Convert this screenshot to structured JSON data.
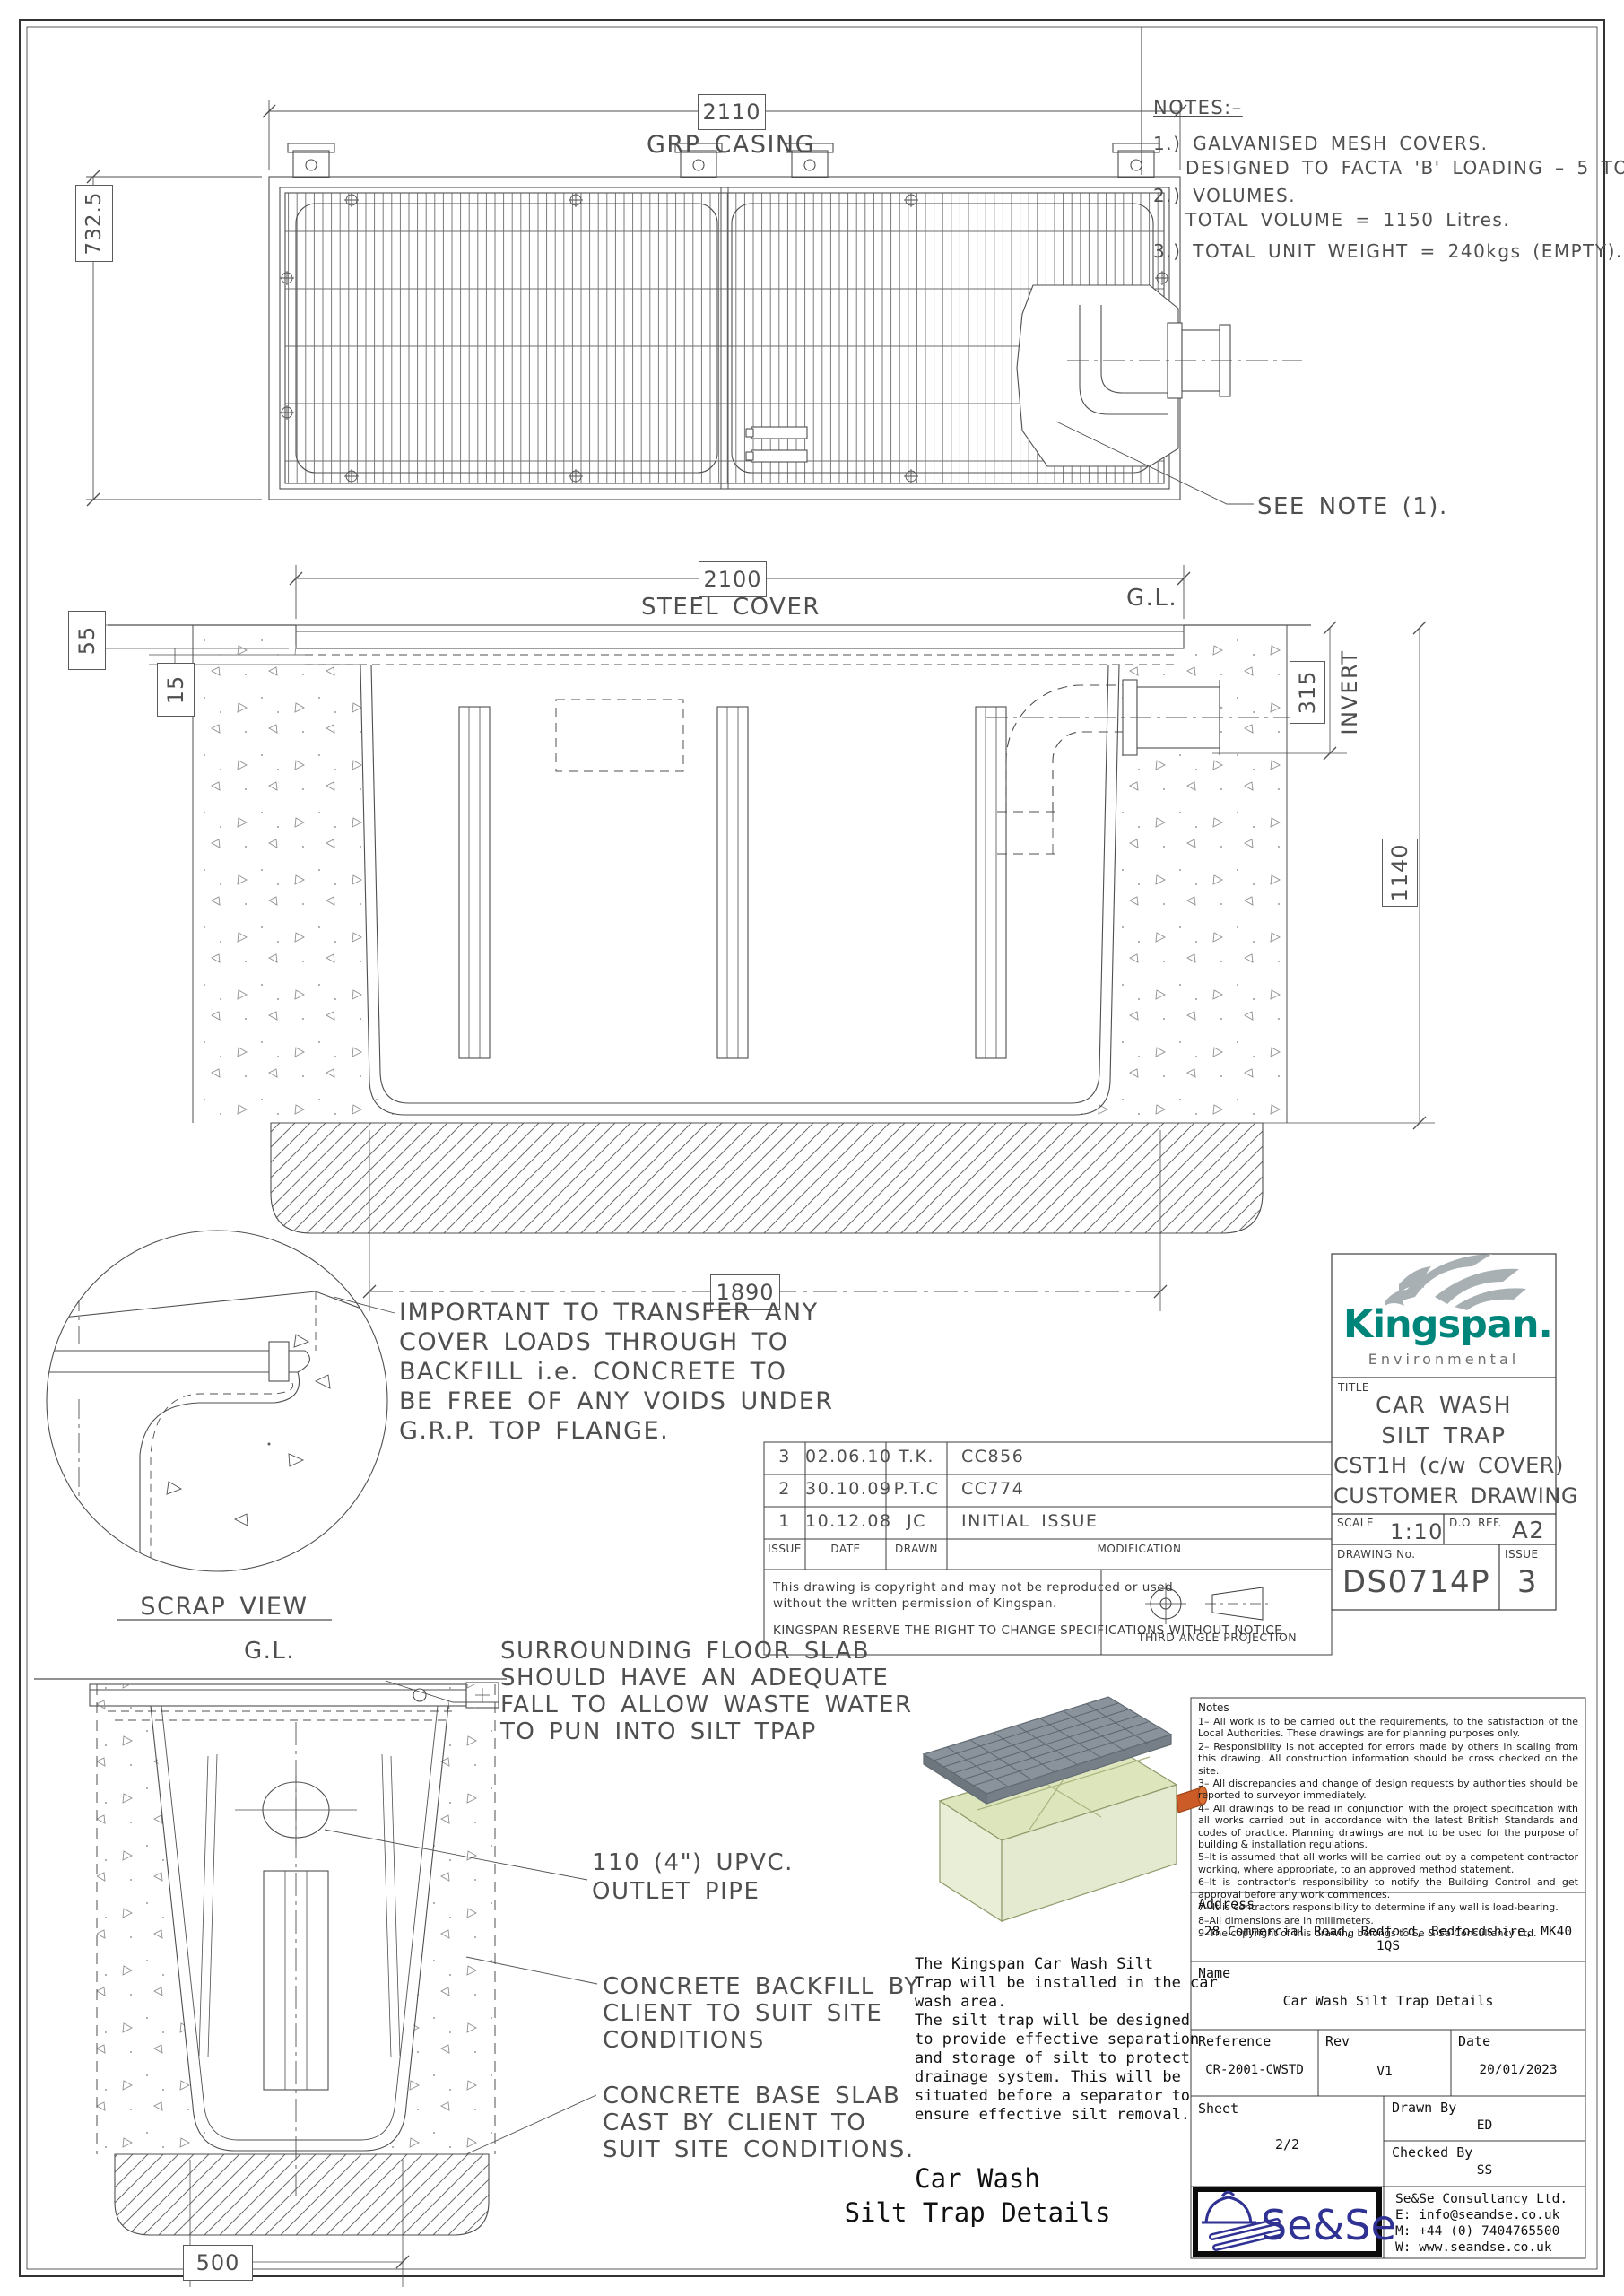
{
  "plan": {
    "dim_width": "2110",
    "title": "GRP CASING",
    "dim_height": "732.5",
    "see_note": "SEE NOTE (1)."
  },
  "notes_top": {
    "heading": "NOTES:–",
    "lines": [
      "1.) GALVANISED MESH COVERS.",
      "DESIGNED TO FACTA 'B' LOADING – 5 TONNE SMW",
      "2.) VOLUMES.",
      "TOTAL VOLUME = 1150 Litres.",
      "3.) TOTAL UNIT WEIGHT = 240kgs (EMPTY)."
    ]
  },
  "section": {
    "dim_top": "2100",
    "cover_label": "STEEL COVER",
    "gl": "G.L.",
    "dim_cover_thk": "55",
    "dim_flange": "15",
    "dim_invert": "315",
    "invert_label": "INVERT",
    "dim_depth": "1140",
    "dim_base_len": "1890"
  },
  "scrap": {
    "label": "SCRAP VIEW",
    "note": [
      "IMPORTANT TO TRANSFER ANY",
      "COVER LOADS THROUGH TO",
      "BACKFILL i.e. CONCRETE TO",
      "BE FREE OF ANY VOIDS UNDER",
      "G.R.P. TOP FLANGE."
    ]
  },
  "revisions": {
    "headers": [
      "ISSUE",
      "DATE",
      "DRAWN",
      "MODIFICATION"
    ],
    "rows": [
      [
        "3",
        "02.06.10",
        "T.K.",
        "CC856"
      ],
      [
        "2",
        "30.10.09",
        "P.T.C",
        "CC774"
      ],
      [
        "1",
        "10.12.08",
        "JC",
        "INITIAL ISSUE"
      ]
    ],
    "copyright": [
      "This drawing is copyright and may not be reproduced or used",
      "without the written permission of Kingspan.",
      "KINGSPAN RESERVE THE RIGHT TO CHANGE SPECIFICATIONS WITHOUT NOTICE"
    ],
    "projection_label": "THIRD ANGLE PROJECTION"
  },
  "brand": {
    "name": "Kingspan.",
    "division": "Environmental",
    "teal": "#00857b"
  },
  "title_block": {
    "title_label": "TITLE",
    "title_lines": [
      "CAR WASH",
      "SILT TRAP",
      "CST1H (c/w COVER)",
      "CUSTOMER DRAWING"
    ],
    "scale_label": "SCALE",
    "scale_value": "1:10",
    "do_ref_label": "D.O. REF.",
    "do_ref_value": "A2",
    "drawing_no_label": "DRAWING No.",
    "drawing_no_value": "DS0714P",
    "issue_label": "ISSUE",
    "issue_value": "3"
  },
  "end_view": {
    "gl": "G.L.",
    "dim_base": "500",
    "floor_note": [
      "SURROUNDING FLOOR SLAB",
      "SHOULD HAVE AN ADEQUATE",
      "FALL TO ALLOW WASTE WATER",
      "TO PUN INTO SILT TPAP"
    ],
    "outlet_note": [
      "110 (4\") UPVC.",
      "OUTLET PIPE"
    ],
    "backfill_note": [
      "CONCRETE BACKFILL BY",
      "CLIENT TO SUIT SITE",
      "CONDITIONS"
    ],
    "base_note": [
      "CONCRETE BASE SLAB",
      "CAST BY CLIENT TO",
      "SUIT SITE CONDITIONS."
    ]
  },
  "description": {
    "lines": [
      "The Kingspan Car Wash Silt",
      "Trap will be installed in the car",
      "wash area.",
      "The silt trap will be designed",
      "to provide effective separation",
      "and storage of silt to protect",
      "drainage system. This will be",
      "situated before a separator to",
      "ensure effective silt removal."
    ],
    "caption": [
      "Car Wash",
      "Silt Trap Details"
    ]
  },
  "sese": {
    "notes_title": "Notes",
    "notes": [
      "1– All work is to be carried out the requirements, to the satisfaction of the Local Authorities. These drawings are for planning purposes only.",
      "2– Responsibility is not accepted for errors made by others in scaling from this drawing. All construction information should be cross checked on the site.",
      "3– All discrepancies and change of design requests by authorities should be reported to surveyor immediately.",
      "4– All drawings to be read in conjunction with the project specification with all works carried out in accordance with the latest British Standards and codes of practice. Planning drawings are not to be used for the purpose of building & installation regulations.",
      "5–It is assumed that all works will be carried out by a competent contractor working, where appropriate, to an approved method statement.",
      "6–It is contractor's responsibility to notify the Building Control and get approval before any work commences.",
      "7– It is contractors responsibility to determine if any wall is load-bearing.",
      "8–All dimensions are in millimeters.",
      "9–The copyright of this drawing belongs to Se & Se Consultancy Ltd."
    ],
    "address_label": "Address",
    "address_value": "28 Commercial Road, Bedford, Bedfordshire, MK40 1QS",
    "name_label": "Name",
    "name_value": "Car Wash Silt Trap Details",
    "reference_label": "Reference",
    "reference_value": "CR-2001-CWSTD",
    "rev_label": "Rev",
    "rev_value": "V1",
    "date_label": "Date",
    "date_value": "20/01/2023",
    "sheet_label": "Sheet",
    "sheet_value": "2/2",
    "drawn_label": "Drawn By",
    "drawn_value": "ED",
    "checked_label": "Checked By",
    "checked_value": "SS",
    "logo_text": "Se&Se",
    "company": "Se&Se Consultancy Ltd.",
    "email": "E: info@seandse.co.uk",
    "phone": "M: +44 (0) 7404765500",
    "web": "W: www.seandse.co.uk",
    "indigo": "#2f3193"
  }
}
